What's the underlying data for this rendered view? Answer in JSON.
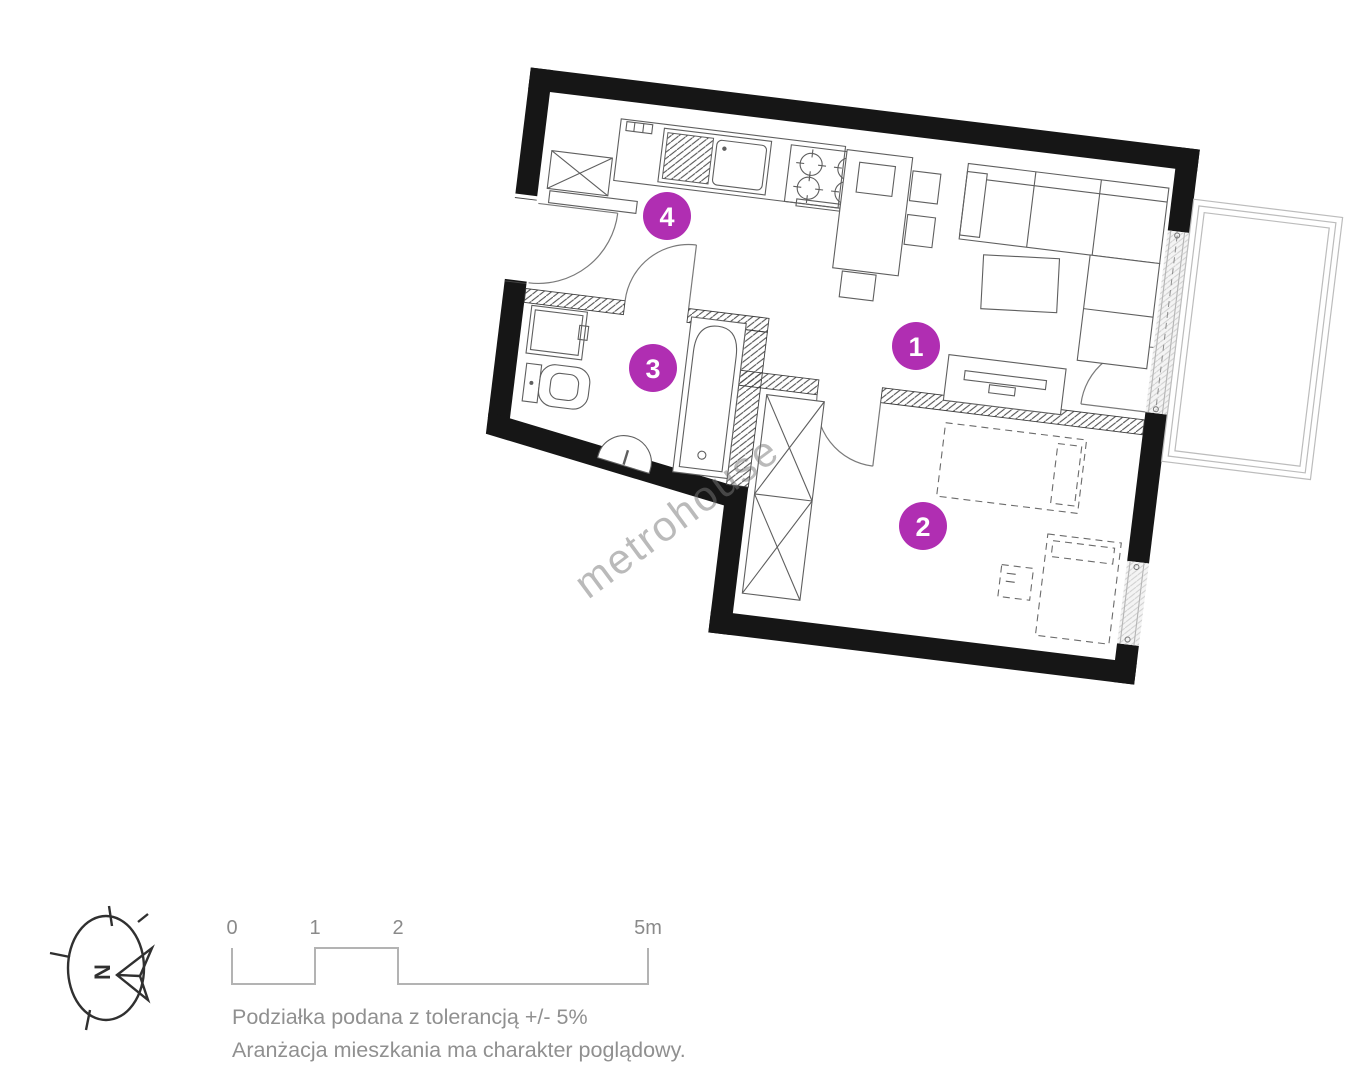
{
  "watermark": {
    "text": "metrohouse"
  },
  "rooms": [
    {
      "label": "1"
    },
    {
      "label": "2"
    },
    {
      "label": "3"
    },
    {
      "label": "4"
    }
  ],
  "legend": {
    "compass": {
      "north_label": "N"
    },
    "scale": {
      "ticks": [
        "0",
        "1",
        "2",
        "5m"
      ]
    },
    "notes": {
      "tolerance": "Podziałka podana z tolerancją +/- 5%",
      "arrangement": "Aranżacja mieszkania ma charakter poglądowy."
    }
  },
  "colors": {
    "room_badge": "#b02eb2",
    "walls": "#161616",
    "furniture_line": "#5f5f5f",
    "legend_text": "#8f8f8f",
    "scale_bar": "#b3b3b3",
    "watermark": "#787878"
  }
}
